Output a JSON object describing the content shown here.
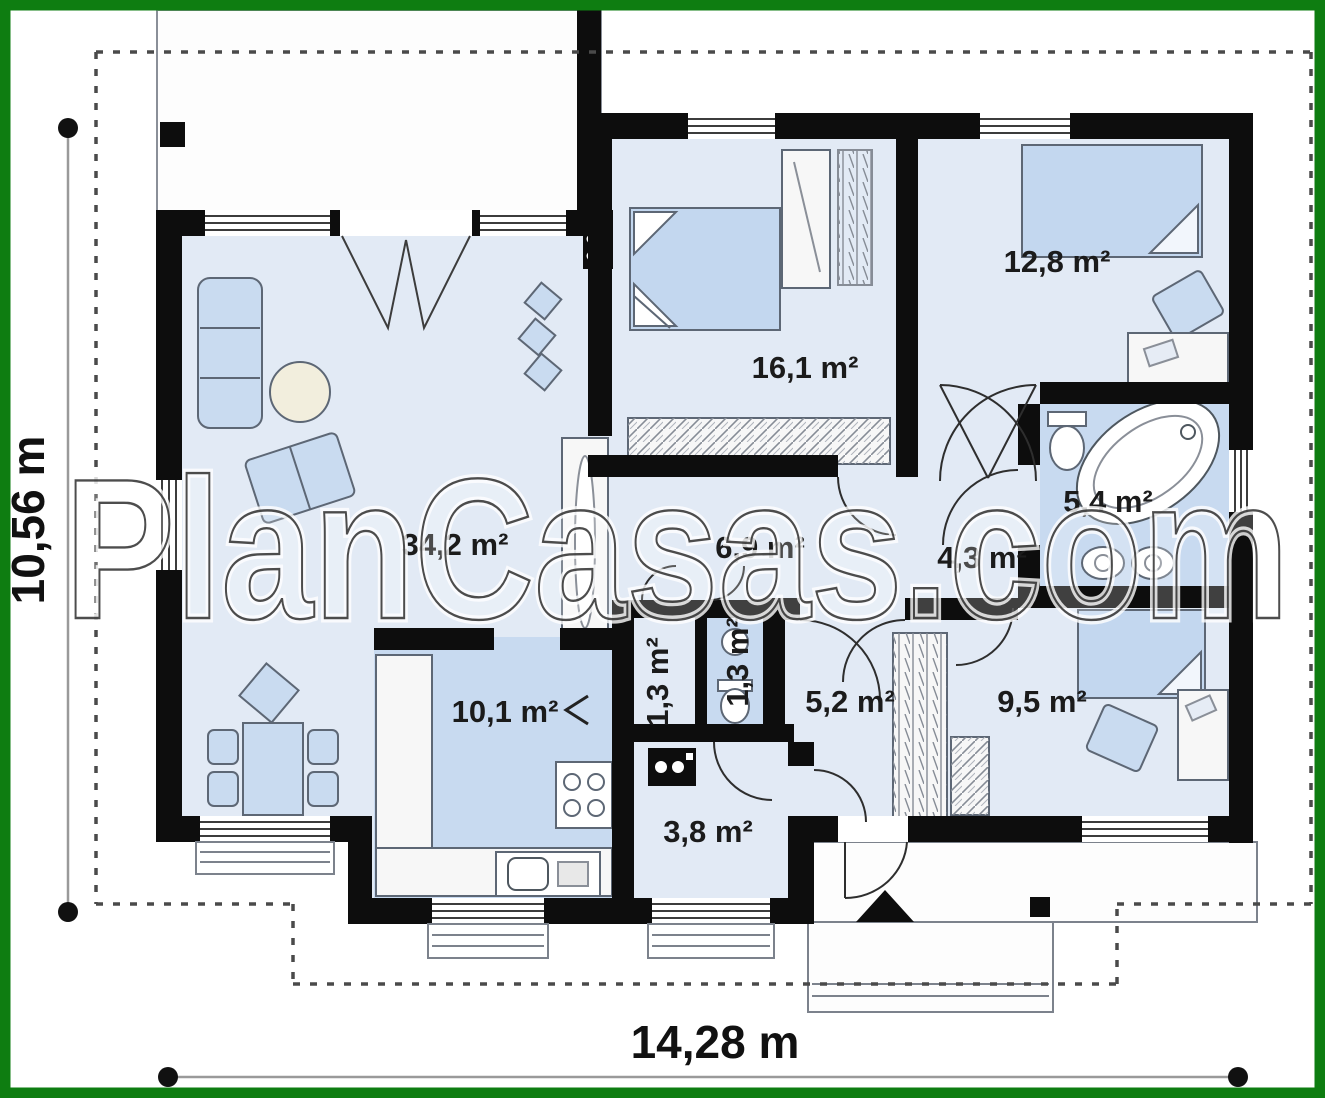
{
  "watermark": {
    "text": "PlanCasas.com"
  },
  "dimensions": {
    "height_label": "10,56 m",
    "width_label": "14,28 m"
  },
  "rooms": [
    {
      "name": "living-room",
      "label": "34,2 m²"
    },
    {
      "name": "bedroom-main",
      "label": "16,1 m²"
    },
    {
      "name": "bedroom-right",
      "label": "12,8 m²"
    },
    {
      "name": "bathroom",
      "label": "5,4 m²"
    },
    {
      "name": "inner-hall",
      "label": "4,3 m²"
    },
    {
      "name": "corridor",
      "label": "6,9 m²"
    },
    {
      "name": "wc-left",
      "label": "1,3 m²"
    },
    {
      "name": "wc-right",
      "label": "1,3 m²"
    },
    {
      "name": "entry-hall",
      "label": "5,2 m²"
    },
    {
      "name": "bedroom-small",
      "label": "9,5 m²"
    },
    {
      "name": "kitchen",
      "label": "10,1 m²"
    },
    {
      "name": "pantry",
      "label": "3,8 m²"
    }
  ],
  "colors": {
    "frame_green": "#0e7d11",
    "wall_black": "#0d0d0d",
    "room_fill_light": "#e2eaf5",
    "room_fill_dark": "#c8daf0",
    "furniture_blue": "#c9dbf0",
    "outline_gray": "#7c828c"
  }
}
